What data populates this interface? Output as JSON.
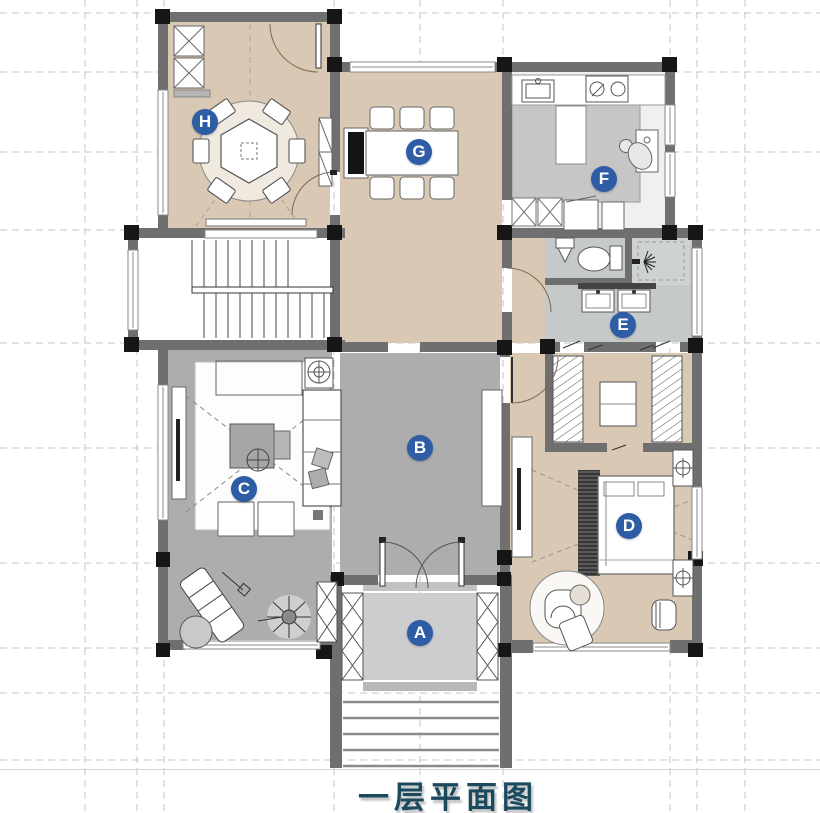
{
  "title": "一层平面图",
  "labels": [
    {
      "letter": "A"
    },
    {
      "letter": "B"
    },
    {
      "letter": "C"
    },
    {
      "letter": "D"
    },
    {
      "letter": "E"
    },
    {
      "letter": "F"
    },
    {
      "letter": "G"
    },
    {
      "letter": "H"
    }
  ],
  "colors": {
    "label_background": "#2e5ca5",
    "label_text": "#ffffff",
    "floor_tan": "#d9c8b3",
    "floor_gray": "#adadad",
    "floor_light_gray": "#c9cbcc",
    "kitchen_gray": "#c6c6c6",
    "wall_gray": "#6f6f6f",
    "column_black": "#161616",
    "title_text": "#1b4a5e"
  }
}
